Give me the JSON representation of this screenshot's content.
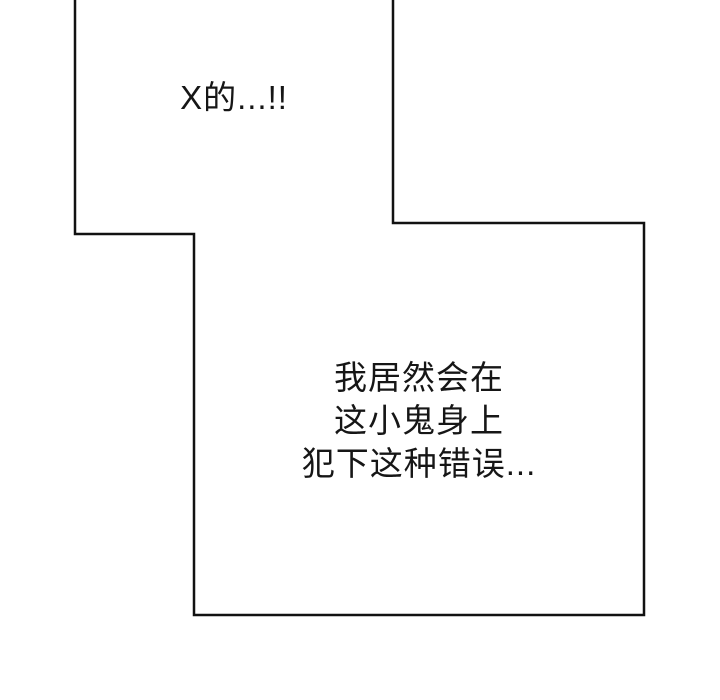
{
  "page": {
    "background_color": "#ffffff",
    "outline_color": "#111111",
    "text_color": "#161616"
  },
  "speech": {
    "top": {
      "text": "X的...!!"
    },
    "bottom": {
      "lines": [
        "我居然会在",
        "这小鬼身上",
        "犯下这种错误..."
      ]
    }
  }
}
